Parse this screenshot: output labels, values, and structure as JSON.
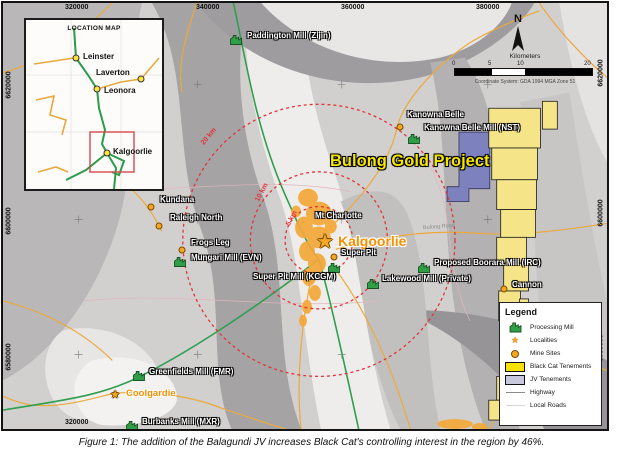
{
  "figure": {
    "caption": "Figure 1: The addition of the Balagundi JV increases Black Cat's controlling interest in the region by 46%."
  },
  "map": {
    "project_label": "Bulong Gold Project",
    "road_label": "Bulong Road",
    "north_label": "N",
    "radius_labels": [
      {
        "text": "20 km",
        "x": 196,
        "y": 130,
        "rot": -50
      },
      {
        "text": "10 km",
        "x": 249,
        "y": 186,
        "rot": -62
      },
      {
        "text": "5 km",
        "x": 281,
        "y": 212,
        "rot": -62
      }
    ],
    "markers": [
      {
        "type": "mill",
        "label": "Paddington Mill (Zijin)",
        "x": 233,
        "y": 35,
        "lx": 244,
        "ly": 29
      },
      {
        "type": "mine",
        "label": "Kanowna Belle",
        "x": 397,
        "y": 124,
        "lx": 404,
        "ly": 108
      },
      {
        "type": "mill",
        "label": "Kanowna Belle Mill (NST)",
        "x": 411,
        "y": 134,
        "lx": 421,
        "ly": 121
      },
      {
        "type": "mine",
        "label": "Kundana",
        "x": 148,
        "y": 204,
        "lx": 157,
        "ly": 193
      },
      {
        "type": "mine",
        "label": "Raleigh North",
        "x": 156,
        "y": 223,
        "lx": 167,
        "ly": 211
      },
      {
        "type": "mine",
        "label": "Frogs Leg",
        "x": 179,
        "y": 247,
        "lx": 188,
        "ly": 236
      },
      {
        "type": "mill",
        "label": "Mungari Mill (EVN)",
        "x": 177,
        "y": 257,
        "lx": 188,
        "ly": 251
      },
      {
        "type": "text-mine",
        "label": "Mt Charlotte",
        "lx": 312,
        "ly": 209
      },
      {
        "type": "locality",
        "label": "Kalgoorlie",
        "star": 20,
        "cls": "lbl-city",
        "x": 322,
        "y": 240,
        "lx": 335,
        "ly": 231
      },
      {
        "type": "mine",
        "label": "Super Pit",
        "x": 331,
        "y": 254,
        "lx": 338,
        "ly": 246
      },
      {
        "type": "mill",
        "label": "Super Pit Mill (KCGM)",
        "x": 331,
        "y": 263,
        "lx": 250,
        "ly": 270
      },
      {
        "type": "mill",
        "label": "Lakewood Mill (Private)",
        "x": 370,
        "y": 279,
        "lx": 379,
        "ly": 272
      },
      {
        "type": "mill",
        "label": "Proposed Boorara Mill (IRC)",
        "x": 421,
        "y": 263,
        "lx": 431,
        "ly": 256
      },
      {
        "type": "mine",
        "label": "Cannon",
        "x": 501,
        "y": 286,
        "lx": 509,
        "ly": 278
      },
      {
        "type": "mill",
        "label": "Greenfields Mill (FMR)",
        "x": 136,
        "y": 371,
        "lx": 146,
        "ly": 365
      },
      {
        "type": "locality",
        "label": "Coolgardie",
        "star": 11,
        "cls": "lbl-city-sm",
        "x": 112,
        "y": 393,
        "lx": 123,
        "ly": 386
      },
      {
        "type": "mill",
        "label": "Burbanks Mill (MXR)",
        "x": 129,
        "y": 421,
        "lx": 139,
        "ly": 415
      }
    ],
    "coords": {
      "top": [
        {
          "text": "320000",
          "x": 62
        },
        {
          "text": "340000",
          "x": 193
        },
        {
          "text": "360000",
          "x": 338
        },
        {
          "text": "380000",
          "x": 473
        }
      ],
      "bottom": [
        {
          "text": "320000",
          "x": 62
        }
      ],
      "left": [
        {
          "text": "6620000",
          "y": 82
        },
        {
          "text": "6600000",
          "y": 218
        },
        {
          "text": "6580000",
          "y": 354
        }
      ],
      "right": [
        {
          "text": "6620000",
          "y": 70
        },
        {
          "text": "6600000",
          "y": 210
        },
        {
          "text": "6580000",
          "y": 345
        }
      ]
    }
  },
  "inset": {
    "title": "LOCATION MAP",
    "towns": [
      {
        "name": "Leinster",
        "x": 50,
        "y": 38,
        "lx": 57,
        "ly": 32
      },
      {
        "name": "Laverton",
        "x": 115,
        "y": 59,
        "lx": 70,
        "ly": 48
      },
      {
        "name": "Leonora",
        "x": 71,
        "y": 69,
        "lx": 78,
        "ly": 66
      },
      {
        "name": "Kalgoorlie",
        "x": 81,
        "y": 133,
        "lx": 87,
        "ly": 127
      }
    ]
  },
  "scalebar": {
    "title": "Kilometers",
    "ticks": [
      {
        "t": "0",
        "x": -2
      },
      {
        "t": "5",
        "x": 34
      },
      {
        "t": "10",
        "x": 63
      },
      {
        "t": "20",
        "x": 130
      }
    ],
    "datum": "Coordinate System: GDA 1994 MGA Zone 51"
  },
  "legend": {
    "title": "Legend",
    "items": [
      "Processing Mill",
      "Localities",
      "Mine Sites",
      "Black Cat Tenements",
      "JV Tenements",
      "Highway",
      "Local Roads"
    ]
  },
  "colors": {
    "radius_red": "#e23438",
    "mill_green": "#2f9e46",
    "marker_orange": "#f5a623",
    "city_orange": "#f78f00",
    "project_yellow": "#f6e600",
    "tenement_yellow": "#f6e588",
    "jv_purple": "#7d81bd",
    "highway_green": "#2f9e4f",
    "local_road_orange": "#eba93e"
  }
}
